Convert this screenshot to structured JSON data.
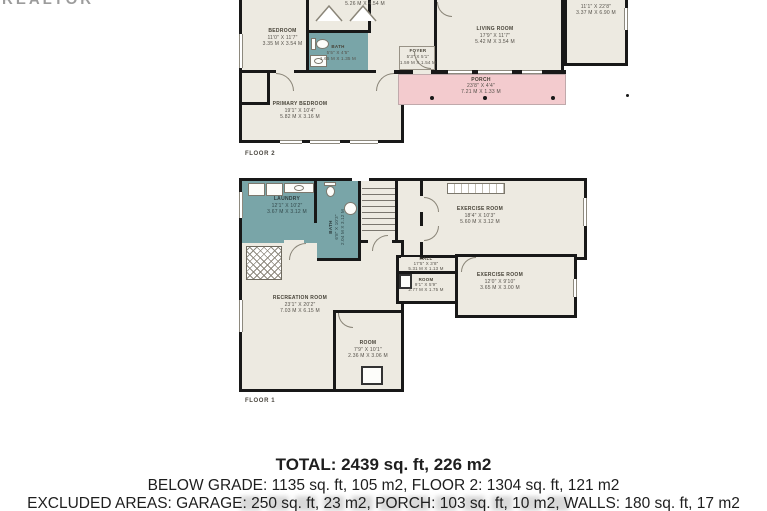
{
  "watermark": "REALTOR",
  "floor2": {
    "label": "FLOOR 2",
    "rooms": {
      "top_partial": {
        "name": "",
        "ft": "",
        "m": "5.26 M X 4.54 M"
      },
      "bedroom": {
        "name": "BEDROOM",
        "ft": "11'0\" X 11'7\"",
        "m": "3.35 M X 3.54 M"
      },
      "bath": {
        "name": "BATH",
        "ft": "5'5\" X 4'5\"",
        "m": "1.65 M X 1.35 M"
      },
      "foyer": {
        "name": "FOYER",
        "ft": "5'3\" X 5'1\"",
        "m": "1.59 M X 1.54 M"
      },
      "living": {
        "name": "LIVING ROOM",
        "ft": "17'9\" X 11'7\"",
        "m": "5.42 M X 3.54 M"
      },
      "garage": {
        "name": "",
        "ft": "11'1\" X 22'8\"",
        "m": "3.37 M X 6.90 M"
      },
      "porch": {
        "name": "PORCH",
        "ft": "23'8\" X 4'4\"",
        "m": "7.21 M X 1.33 M"
      },
      "primary": {
        "name": "PRIMARY BEDROOM",
        "ft": "19'1\" X 10'4\"",
        "m": "5.82 M X 3.16 M"
      }
    }
  },
  "floor1": {
    "label": "FLOOR 1",
    "rooms": {
      "laundry": {
        "name": "LAUNDRY",
        "ft": "12'1\" X 10'2\"",
        "m": "3.67 M X 3.12 M"
      },
      "bath": {
        "name": "BATH",
        "ft": "6'8\" X 10'3\"",
        "m": "2.04 M X 3.12 M"
      },
      "exercise1": {
        "name": "EXERCISE ROOM",
        "ft": "18'4\" X 10'3\"",
        "m": "5.60 M X 3.12 M"
      },
      "hall": {
        "name": "HALL",
        "ft": "17'5\" X 3'8\"",
        "m": "5.31 M X 1.13 M"
      },
      "small_room": {
        "name": "ROOM",
        "ft": "9'1\" X 5'9\"",
        "m": "2.77 M X 1.75 M"
      },
      "exercise2": {
        "name": "EXERCISE ROOM",
        "ft": "12'0\" X 9'10\"",
        "m": "3.65 M X 3.00 M"
      },
      "recreation": {
        "name": "RECREATION ROOM",
        "ft": "23'1\" X 20'2\"",
        "m": "7.03 M X 6.15 M"
      },
      "room_bottom": {
        "name": "ROOM",
        "ft": "7'9\" X 10'1\"",
        "m": "2.36 M X 3.06 M"
      }
    }
  },
  "summary": {
    "total": "TOTAL: 2439 sq. ft, 226 m2",
    "grades": "BELOW GRADE: 1135 sq. ft, 105 m2, FLOOR 2: 1304 sq. ft, 121 m2",
    "excluded": "EXCLUDED AREAS: GARAGE: 250 sq. ft, 23 m2, PORCH: 103 sq. ft, 10 m2, WALLS: 180 sq. ft, 17 m2"
  }
}
